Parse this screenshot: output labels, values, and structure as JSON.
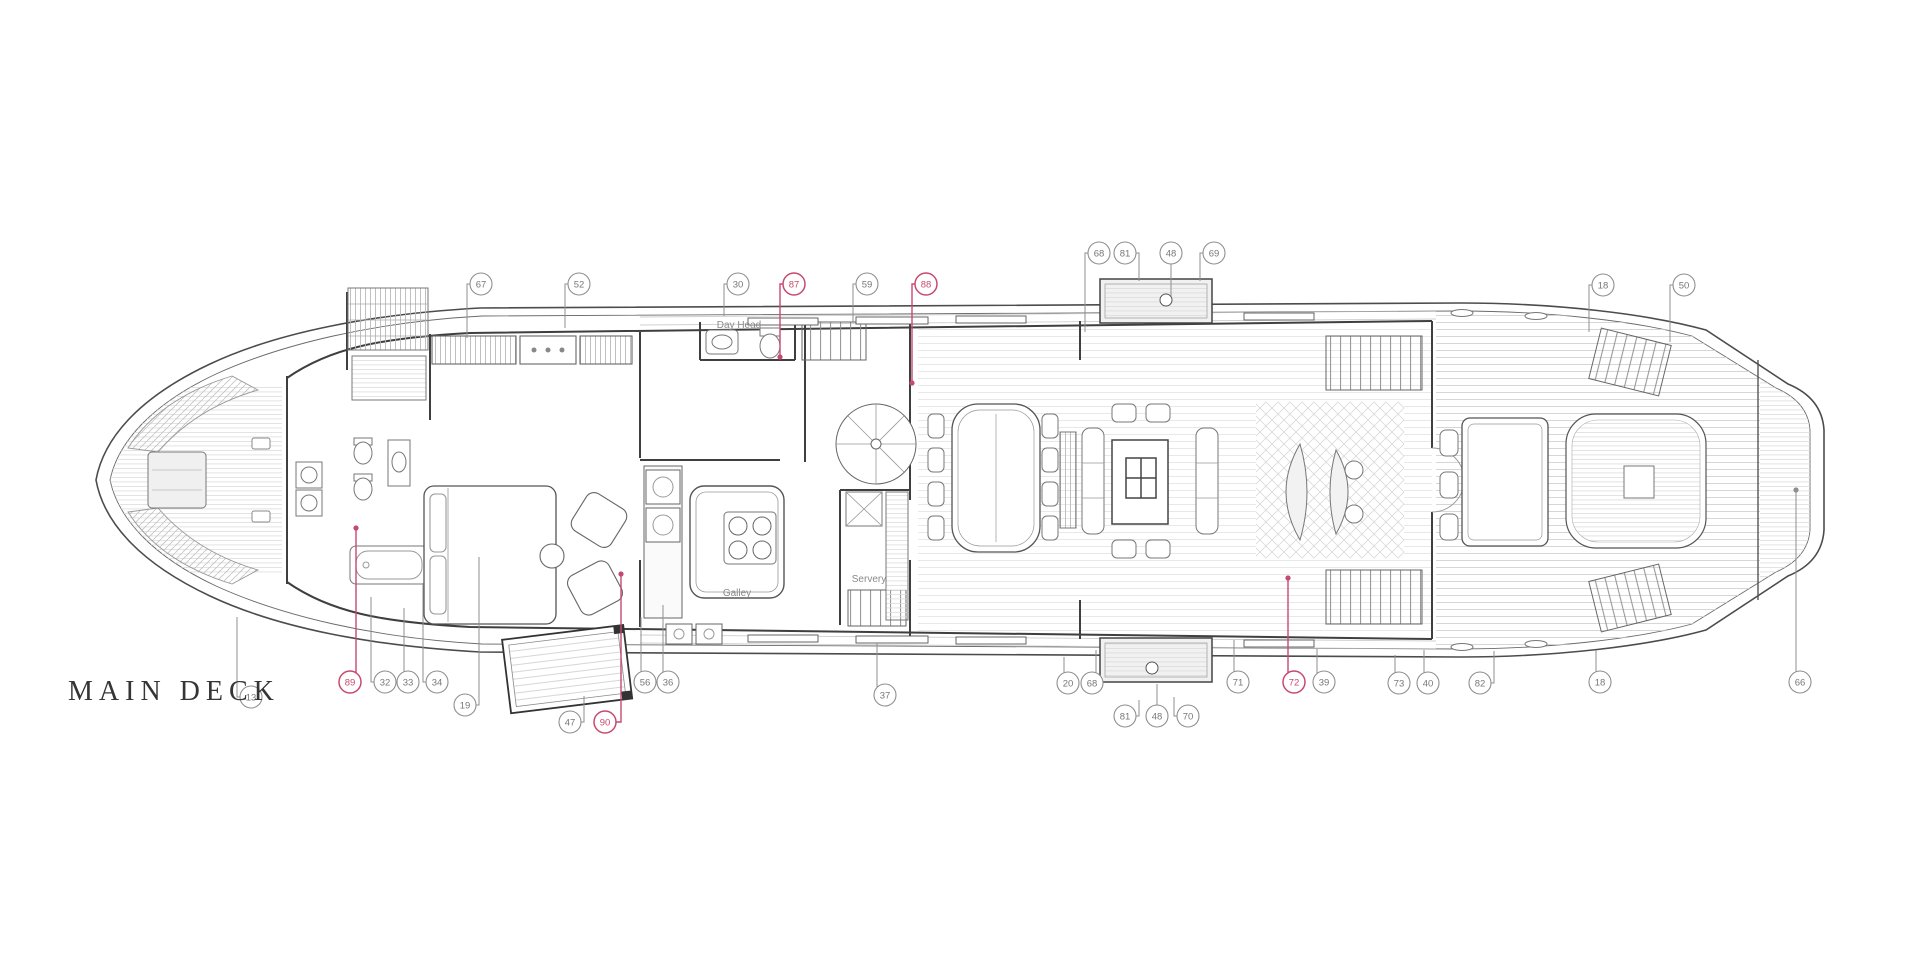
{
  "title": "MAIN DECK",
  "colors": {
    "line": "#4c4c4c",
    "wall": "#3f3f3f",
    "hatch": "#c9c9c9",
    "fill_light": "#f1f1f1",
    "pink": "#C64A70",
    "callout_stroke": "#8f8f8f",
    "callout_text": "#777777",
    "title_color": "#353535",
    "label_color": "#8a8a8a"
  },
  "plan_labels": [
    {
      "text": "Day Head",
      "x": 739,
      "y": 328
    },
    {
      "text": "Galley",
      "x": 737,
      "y": 596
    },
    {
      "text": "Servery",
      "x": 869,
      "y": 582
    }
  ],
  "callouts": [
    {
      "n": "67",
      "x": 481,
      "y": 284,
      "lead": [
        [
          470,
          284
        ],
        [
          467,
          284
        ],
        [
          467,
          338
        ]
      ]
    },
    {
      "n": "52",
      "x": 579,
      "y": 284,
      "lead": [
        [
          568,
          284
        ],
        [
          565,
          284
        ],
        [
          565,
          328
        ]
      ]
    },
    {
      "n": "30",
      "x": 738,
      "y": 284,
      "lead": [
        [
          727,
          284
        ],
        [
          724,
          284
        ],
        [
          724,
          316
        ]
      ]
    },
    {
      "n": "87",
      "x": 794,
      "y": 284,
      "pink": true,
      "lead": [
        [
          783,
          284
        ],
        [
          780,
          284
        ],
        [
          780,
          356
        ]
      ],
      "dot": [
        780,
        357
      ]
    },
    {
      "n": "59",
      "x": 867,
      "y": 284,
      "lead": [
        [
          856,
          284
        ],
        [
          853,
          284
        ],
        [
          853,
          322
        ]
      ]
    },
    {
      "n": "88",
      "x": 926,
      "y": 284,
      "pink": true,
      "lead": [
        [
          915,
          284
        ],
        [
          912,
          284
        ],
        [
          912,
          382
        ]
      ],
      "dot": [
        912,
        383
      ]
    },
    {
      "n": "68",
      "x": 1099,
      "y": 253,
      "lead": [
        [
          1088,
          253
        ],
        [
          1085,
          253
        ],
        [
          1085,
          332
        ]
      ]
    },
    {
      "n": "81",
      "x": 1125,
      "y": 253,
      "lead": [
        [
          1136,
          253
        ],
        [
          1139,
          253
        ],
        [
          1139,
          281
        ]
      ]
    },
    {
      "n": "48",
      "x": 1171,
      "y": 253,
      "lead": [
        [
          1171,
          264
        ],
        [
          1171,
          296
        ]
      ]
    },
    {
      "n": "69",
      "x": 1214,
      "y": 253,
      "lead": [
        [
          1203,
          253
        ],
        [
          1200,
          253
        ],
        [
          1200,
          281
        ]
      ]
    },
    {
      "n": "18",
      "x": 1603,
      "y": 285,
      "lead": [
        [
          1592,
          285
        ],
        [
          1589,
          285
        ],
        [
          1589,
          332
        ]
      ]
    },
    {
      "n": "50",
      "x": 1684,
      "y": 285,
      "lead": [
        [
          1673,
          285
        ],
        [
          1670,
          285
        ],
        [
          1670,
          342
        ]
      ]
    },
    {
      "n": "13",
      "x": 251,
      "y": 697,
      "lead": [
        [
          240,
          697
        ],
        [
          237,
          697
        ],
        [
          237,
          617
        ]
      ]
    },
    {
      "n": "89",
      "x": 350,
      "y": 682,
      "pink": true,
      "lead": [
        [
          356,
          673
        ],
        [
          356,
          530
        ]
      ],
      "dot": [
        356,
        528
      ]
    },
    {
      "n": "32",
      "x": 385,
      "y": 682,
      "lead": [
        [
          374,
          682
        ],
        [
          371,
          682
        ],
        [
          371,
          597
        ]
      ]
    },
    {
      "n": "33",
      "x": 408,
      "y": 682,
      "lead": [
        [
          404,
          673
        ],
        [
          404,
          608
        ]
      ]
    },
    {
      "n": "34",
      "x": 437,
      "y": 682,
      "lead": [
        [
          426,
          682
        ],
        [
          423,
          682
        ],
        [
          423,
          584
        ]
      ]
    },
    {
      "n": "19",
      "x": 465,
      "y": 705,
      "lead": [
        [
          476,
          705
        ],
        [
          479,
          705
        ],
        [
          479,
          557
        ]
      ]
    },
    {
      "n": "47",
      "x": 570,
      "y": 722,
      "lead": [
        [
          581,
          722
        ],
        [
          584,
          722
        ],
        [
          584,
          696
        ]
      ]
    },
    {
      "n": "90",
      "x": 605,
      "y": 722,
      "pink": true,
      "lead": [
        [
          616,
          722
        ],
        [
          621,
          722
        ],
        [
          621,
          576
        ]
      ],
      "dot": [
        621,
        574
      ]
    },
    {
      "n": "56",
      "x": 645,
      "y": 682,
      "lead": [
        [
          641,
          672
        ],
        [
          641,
          617
        ]
      ]
    },
    {
      "n": "36",
      "x": 668,
      "y": 682,
      "lead": [
        [
          663,
          672
        ],
        [
          663,
          605
        ]
      ]
    },
    {
      "n": "37",
      "x": 885,
      "y": 695,
      "lead": [
        [
          877,
          687
        ],
        [
          877,
          643
        ]
      ]
    },
    {
      "n": "20",
      "x": 1068,
      "y": 683,
      "lead": [
        [
          1064,
          673
        ],
        [
          1064,
          657
        ]
      ]
    },
    {
      "n": "68",
      "x": 1092,
      "y": 683,
      "lead": [
        [
          1096,
          673
        ],
        [
          1096,
          650
        ]
      ]
    },
    {
      "n": "81",
      "x": 1125,
      "y": 716,
      "lead": [
        [
          1136,
          716
        ],
        [
          1139,
          716
        ],
        [
          1139,
          700
        ]
      ]
    },
    {
      "n": "48",
      "x": 1157,
      "y": 716,
      "lead": [
        [
          1157,
          705
        ],
        [
          1157,
          684
        ]
      ]
    },
    {
      "n": "70",
      "x": 1188,
      "y": 716,
      "lead": [
        [
          1177,
          716
        ],
        [
          1174,
          716
        ],
        [
          1174,
          697
        ]
      ]
    },
    {
      "n": "71",
      "x": 1238,
      "y": 682,
      "lead": [
        [
          1234,
          672
        ],
        [
          1234,
          640
        ]
      ]
    },
    {
      "n": "72",
      "x": 1294,
      "y": 682,
      "pink": true,
      "lead": [
        [
          1288,
          673
        ],
        [
          1288,
          579
        ]
      ],
      "dot": [
        1288,
        578
      ]
    },
    {
      "n": "39",
      "x": 1324,
      "y": 682,
      "lead": [
        [
          1317,
          674
        ],
        [
          1317,
          649
        ]
      ]
    },
    {
      "n": "73",
      "x": 1399,
      "y": 683,
      "lead": [
        [
          1395,
          673
        ],
        [
          1395,
          655
        ]
      ]
    },
    {
      "n": "40",
      "x": 1428,
      "y": 683,
      "lead": [
        [
          1424,
          673
        ],
        [
          1424,
          650
        ]
      ]
    },
    {
      "n": "82",
      "x": 1480,
      "y": 683,
      "lead": [
        [
          1491,
          683
        ],
        [
          1494,
          683
        ],
        [
          1494,
          651
        ]
      ]
    },
    {
      "n": "18",
      "x": 1600,
      "y": 682,
      "lead": [
        [
          1596,
          672
        ],
        [
          1596,
          650
        ]
      ]
    },
    {
      "n": "66",
      "x": 1800,
      "y": 682,
      "lead": [
        [
          1796,
          672
        ],
        [
          1796,
          492
        ]
      ],
      "dot": [
        1796,
        490
      ]
    }
  ]
}
